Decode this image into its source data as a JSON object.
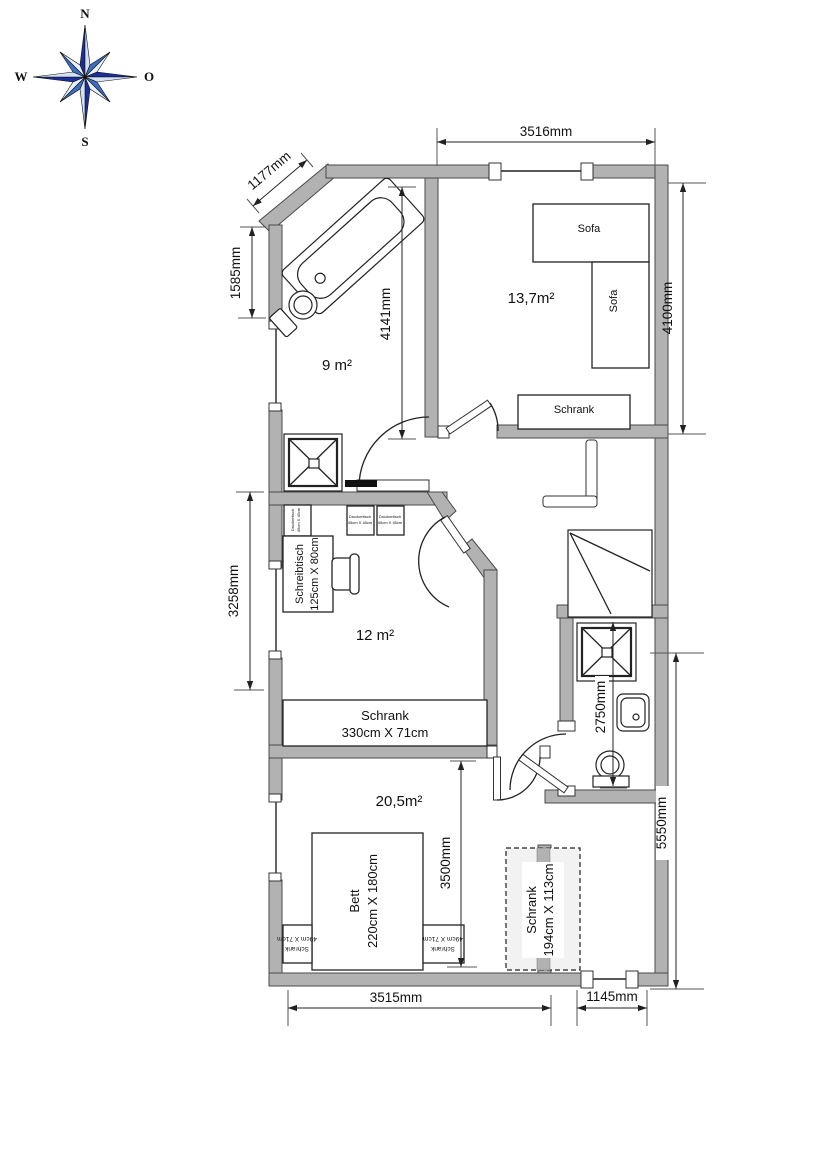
{
  "compass": {
    "north": "N",
    "east": "O",
    "south": "S",
    "west": "W"
  },
  "dims": {
    "d3516": "3516mm",
    "d1177": "1177mm",
    "d1585": "1585mm",
    "d4141": "4141mm",
    "d4100": "4100mm",
    "d3258": "3258mm",
    "d2750": "2750mm",
    "d5550": "5550mm",
    "d3500": "3500mm",
    "d3515": "3515mm",
    "d1145": "1145mm"
  },
  "rooms": {
    "bath1": "9 m²",
    "living": "13,7m²",
    "office": "12 m²",
    "bedroom": "20,5m²"
  },
  "furniture": {
    "sofa_h": "Sofa",
    "sofa_v": "Sofa",
    "schrank_living": "Schrank",
    "desk_l1": "Schreibtisch",
    "desk_l2": "125cm X 80cm",
    "printer_l1": "Druckertisch",
    "printer_l2": "45cm X 45cm",
    "schrank330_l1": "Schrank",
    "schrank330_l2": "330cm X 71cm",
    "bett_l1": "Bett",
    "bett_l2": "220cm X 180cm",
    "nightstand_l1": "Schrank",
    "nightstand_l2": "49cm X 71cm",
    "wardrobe_l1": "Schrank",
    "wardrobe_l2": "194cm X 113cm"
  },
  "colors": {
    "wall": "#b2b2b2",
    "compass_navy": "#1b2f9b",
    "compass_mid": "#3c6fc4",
    "compass_pale": "#d3e1f2"
  }
}
